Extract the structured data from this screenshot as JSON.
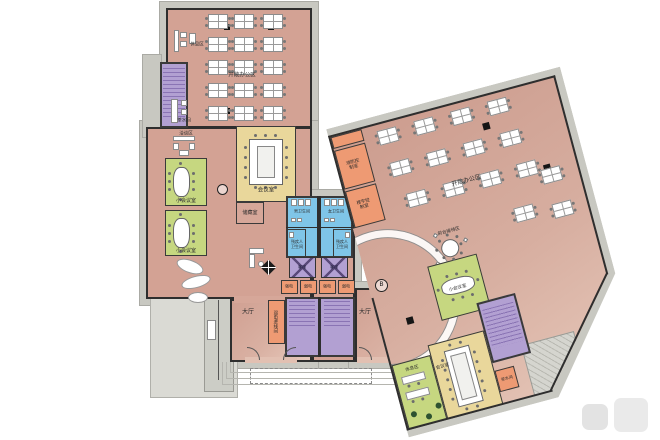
{
  "plan": {
    "type": "office-floor-plan",
    "markers": {
      "location": "B"
    },
    "colors": {
      "floor": "#d3a294",
      "wall": "#2e2e2e",
      "meeting_room": "#e9d79b",
      "small_meeting_room": "#c6d780",
      "restroom": "#7fc5e8",
      "stairs_elevators": "#b2a0d2",
      "service_rooms": "#ee9a73",
      "exterior": "#c8c8c1"
    },
    "rooms": {
      "open_office_north": {
        "label": "开敞办公区"
      },
      "open_office_east": {
        "label": "开敞办公区"
      },
      "lounge_north": {
        "label": "休息区"
      },
      "pantry_north": {
        "label": "茶水间"
      },
      "lounge_west": {
        "label": "洽谈区"
      },
      "small_meeting_a": {
        "label": "小会议室"
      },
      "small_meeting_b": {
        "label": "小会议室"
      },
      "meeting_main": {
        "label": "会议室"
      },
      "storage": {
        "label": "储藏室"
      },
      "mens_wc": {
        "label": "男卫生间"
      },
      "womens_wc": {
        "label": "女卫生间"
      },
      "accessible_wc_left": {
        "label": "残疾人卫生间"
      },
      "accessible_wc_right": {
        "label": "残疾人卫生间"
      },
      "elevator_a": {
        "label": "客梯"
      },
      "elevator_b": {
        "label": "客梯"
      },
      "shaft_1": {
        "label": "强电"
      },
      "shaft_2": {
        "label": "弱电"
      },
      "shaft_3": {
        "label": "强电"
      },
      "shaft_4": {
        "label": "弱电"
      },
      "utility": {
        "label": "弱电进线间"
      },
      "hall_west": {
        "label": "大厅"
      },
      "hall_east": {
        "label": "大厅"
      },
      "fire_control": {
        "label": "消防控制室"
      },
      "building_control": {
        "label": "楼宇控制室"
      },
      "reception": {
        "label": "前台接待区"
      },
      "small_meeting_east": {
        "label": "小会议室"
      },
      "meeting_east": {
        "label": "会议室"
      },
      "lounge_east": {
        "label": "休息区"
      },
      "pantry_east": {
        "label": "茶水间"
      }
    }
  }
}
